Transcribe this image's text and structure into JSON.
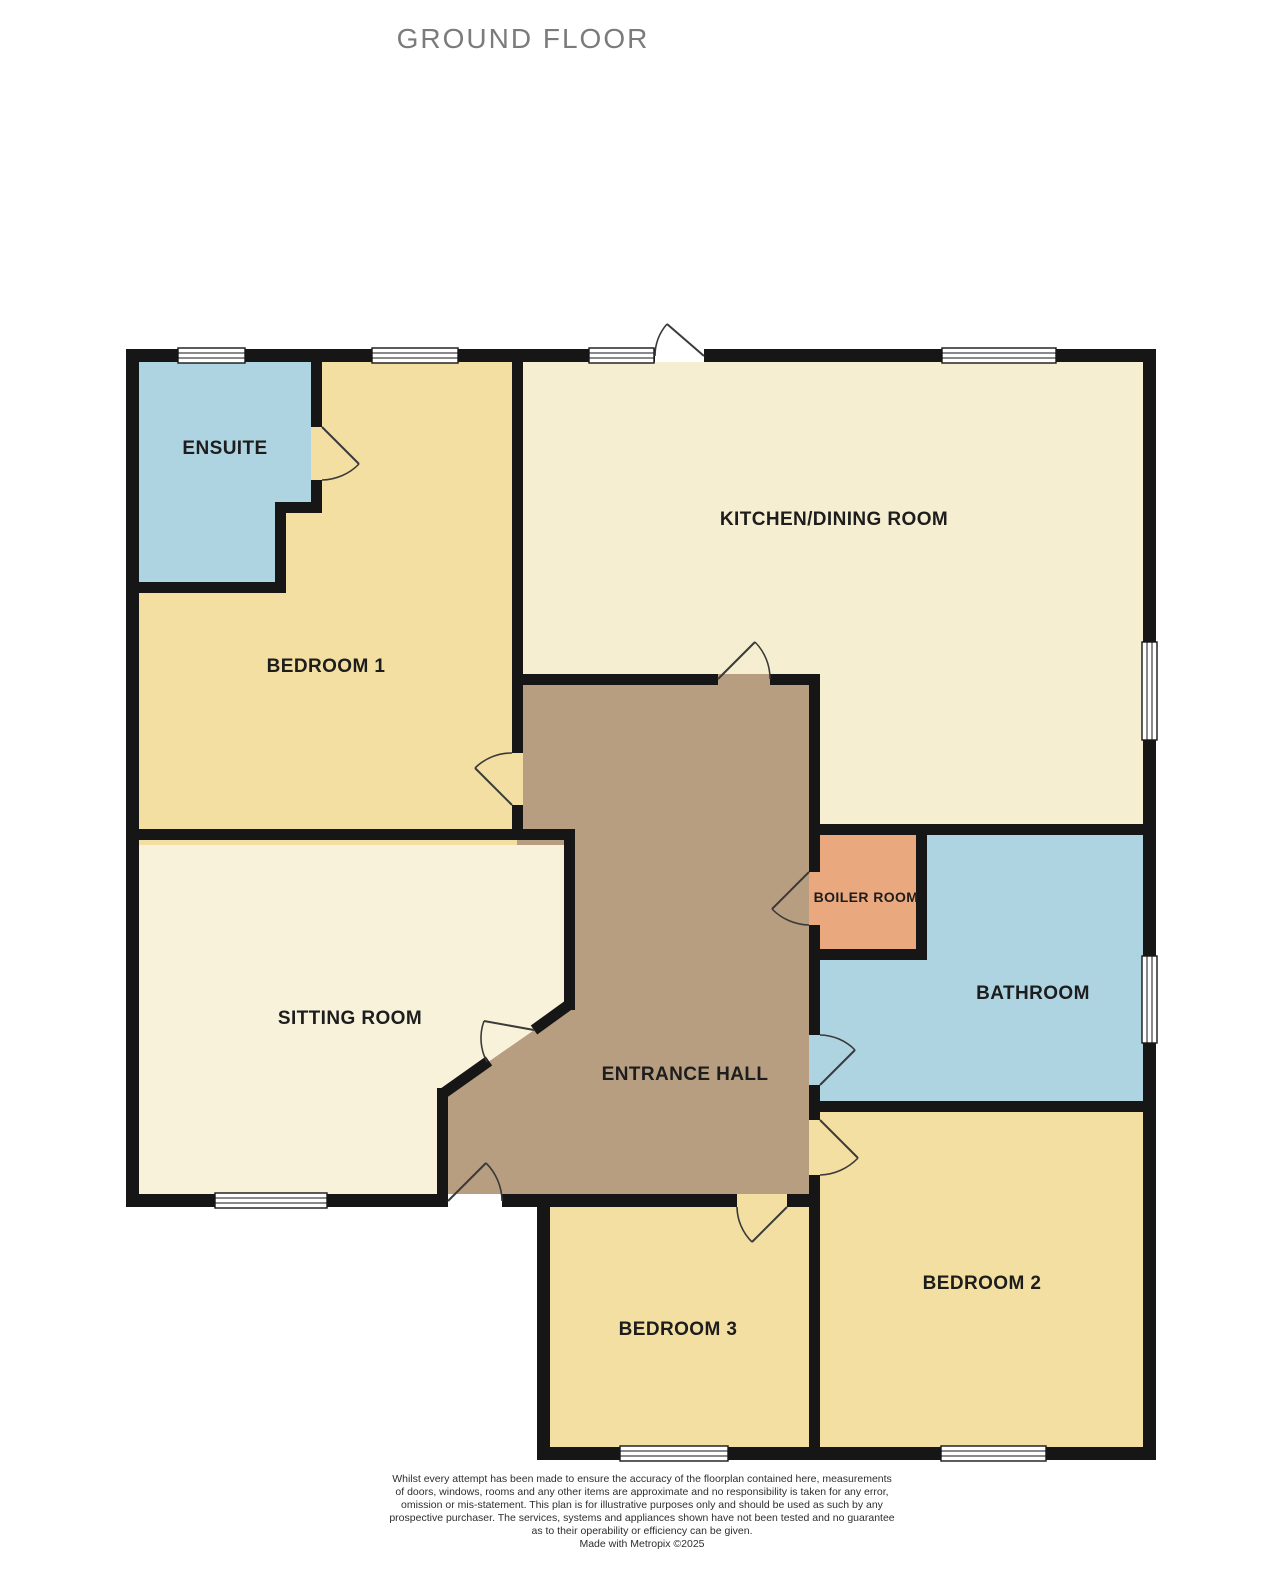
{
  "page": {
    "background": "#ffffff"
  },
  "title": "GROUND FLOOR",
  "floorplan": {
    "wall_color": "#161616",
    "rooms": [
      {
        "name": "ENSUITE",
        "color": "#aed4e2"
      },
      {
        "name": "BEDROOM 1",
        "color": "#f3dfa1"
      },
      {
        "name": "KITCHEN/DINING ROOM",
        "color": "#f5eed1"
      },
      {
        "name": "SITTING ROOM",
        "color": "#f8f2da"
      },
      {
        "name": "ENTRANCE HALL",
        "color": "#b89e80"
      },
      {
        "name": "BOILER ROOM",
        "color": "#e9a87e"
      },
      {
        "name": "BATHROOM",
        "color": "#aed4e2"
      },
      {
        "name": "BEDROOM 2",
        "color": "#f3dfa1"
      },
      {
        "name": "BEDROOM 3",
        "color": "#f3dfa1"
      }
    ]
  },
  "footer": {
    "disclaimer_lines": [
      "Whilst every attempt has been made to ensure the accuracy of the floorplan contained here, measurements",
      "of doors, windows, rooms and any other items are approximate and no responsibility is taken for any error,",
      "omission or mis-statement. This plan is for illustrative purposes only and should be used as such by any",
      "prospective purchaser. The services, systems and appliances shown have not been tested and no guarantee",
      "as to their operability or efficiency can be given."
    ],
    "credit": "Made with Metropix ©2025"
  }
}
